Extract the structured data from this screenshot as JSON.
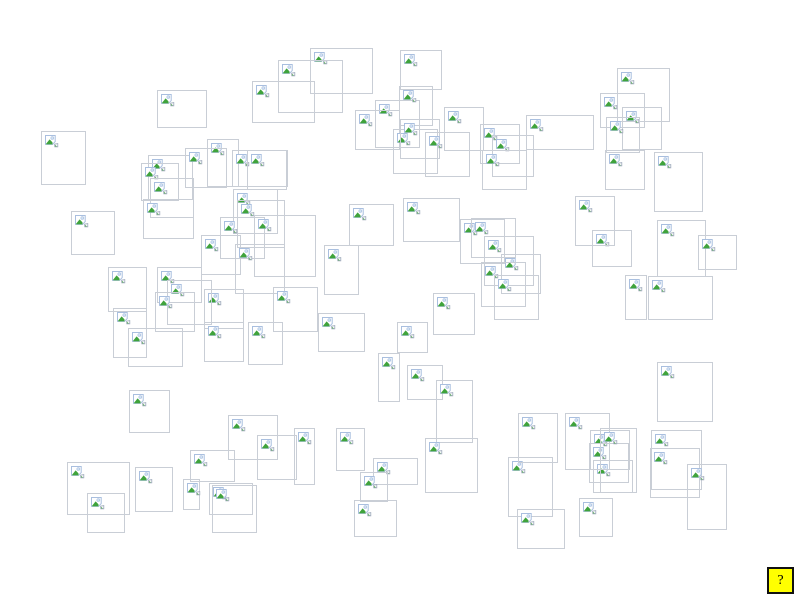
{
  "canvas": {
    "background": "#ffffff",
    "width": 800,
    "height": 600
  },
  "boxes": {
    "border_color": "#c9ced6",
    "icon_name": "broken-image-icon",
    "icon_colors": {
      "frame": "#a9bfdf",
      "sky": "#cfe0f2",
      "hill": "#3fa33c",
      "fragment_edge": "#9aa6b8"
    },
    "items": [
      [
        157,
        90,
        50,
        38
      ],
      [
        41,
        131,
        45,
        54
      ],
      [
        71,
        211,
        44,
        44
      ],
      [
        148,
        155,
        45,
        45
      ],
      [
        141,
        163,
        38,
        38
      ],
      [
        150,
        178,
        44,
        40
      ],
      [
        207,
        139,
        32,
        48
      ],
      [
        185,
        148,
        42,
        40
      ],
      [
        143,
        199,
        51,
        40
      ],
      [
        232,
        150,
        56,
        37
      ],
      [
        247,
        150,
        40,
        40
      ],
      [
        233,
        189,
        45,
        45
      ],
      [
        237,
        200,
        48,
        48
      ],
      [
        220,
        217,
        45,
        42
      ],
      [
        254,
        215,
        62,
        62
      ],
      [
        201,
        235,
        40,
        40
      ],
      [
        235,
        244,
        50,
        50
      ],
      [
        349,
        204,
        45,
        42
      ],
      [
        324,
        245,
        35,
        50
      ],
      [
        204,
        289,
        40,
        40
      ],
      [
        273,
        287,
        45,
        45
      ],
      [
        204,
        322,
        40,
        40
      ],
      [
        248,
        322,
        35,
        43
      ],
      [
        310,
        48,
        63,
        46
      ],
      [
        278,
        60,
        65,
        53
      ],
      [
        252,
        81,
        63,
        42
      ],
      [
        375,
        100,
        45,
        48
      ],
      [
        355,
        110,
        45,
        40
      ],
      [
        393,
        129,
        45,
        45
      ],
      [
        400,
        50,
        42,
        40
      ],
      [
        399,
        86,
        34,
        40
      ],
      [
        444,
        107,
        40,
        44
      ],
      [
        400,
        119,
        40,
        40
      ],
      [
        425,
        132,
        45,
        45
      ],
      [
        480,
        124,
        40,
        40
      ],
      [
        492,
        135,
        42,
        42
      ],
      [
        526,
        115,
        68,
        35
      ],
      [
        482,
        150,
        45,
        40
      ],
      [
        617,
        68,
        53,
        54
      ],
      [
        600,
        93,
        45,
        35
      ],
      [
        622,
        107,
        40,
        43
      ],
      [
        606,
        117,
        34,
        36
      ],
      [
        605,
        150,
        40,
        40
      ],
      [
        654,
        152,
        49,
        60
      ],
      [
        657,
        220,
        49,
        57
      ],
      [
        698,
        235,
        39,
        35
      ],
      [
        592,
        230,
        40,
        37
      ],
      [
        575,
        196,
        40,
        50
      ],
      [
        625,
        275,
        22,
        45
      ],
      [
        648,
        276,
        65,
        44
      ],
      [
        657,
        362,
        56,
        60
      ],
      [
        113,
        308,
        34,
        50
      ],
      [
        128,
        328,
        55,
        39
      ],
      [
        129,
        390,
        41,
        43
      ],
      [
        157,
        267,
        45,
        36
      ],
      [
        167,
        280,
        45,
        45
      ],
      [
        155,
        292,
        40,
        40
      ],
      [
        108,
        267,
        39,
        45
      ],
      [
        318,
        313,
        47,
        39
      ],
      [
        397,
        322,
        31,
        31
      ],
      [
        378,
        353,
        22,
        49
      ],
      [
        228,
        415,
        50,
        45
      ],
      [
        257,
        435,
        40,
        45
      ],
      [
        294,
        428,
        21,
        57
      ],
      [
        336,
        428,
        29,
        43
      ],
      [
        373,
        458,
        45,
        27
      ],
      [
        360,
        472,
        28,
        30
      ],
      [
        354,
        500,
        43,
        37
      ],
      [
        67,
        462,
        63,
        53
      ],
      [
        87,
        493,
        38,
        40
      ],
      [
        135,
        467,
        38,
        45
      ],
      [
        183,
        479,
        17,
        31
      ],
      [
        190,
        450,
        45,
        32
      ],
      [
        209,
        483,
        44,
        32
      ],
      [
        212,
        485,
        45,
        48
      ],
      [
        508,
        457,
        45,
        60
      ],
      [
        517,
        509,
        48,
        40
      ],
      [
        579,
        498,
        34,
        39
      ],
      [
        593,
        460,
        40,
        33
      ],
      [
        565,
        413,
        45,
        57
      ],
      [
        518,
        413,
        40,
        50
      ],
      [
        590,
        430,
        40,
        40
      ],
      [
        589,
        443,
        40,
        40
      ],
      [
        460,
        219,
        45,
        45
      ],
      [
        471,
        218,
        45,
        40
      ],
      [
        484,
        236,
        50,
        50
      ],
      [
        501,
        254,
        40,
        40
      ],
      [
        481,
        262,
        45,
        45
      ],
      [
        494,
        275,
        45,
        45
      ],
      [
        433,
        293,
        42,
        42
      ],
      [
        403,
        198,
        57,
        44
      ],
      [
        407,
        365,
        36,
        35
      ],
      [
        436,
        380,
        37,
        63
      ],
      [
        425,
        438,
        53,
        55
      ],
      [
        600,
        428,
        37,
        65
      ],
      [
        651,
        430,
        51,
        60
      ],
      [
        650,
        448,
        50,
        50
      ],
      [
        687,
        464,
        40,
        66
      ]
    ]
  },
  "help_button": {
    "label": "?",
    "x": 767,
    "y": 567,
    "width": 27,
    "height": 27,
    "background": "#ffff00",
    "border_color": "#111111"
  }
}
